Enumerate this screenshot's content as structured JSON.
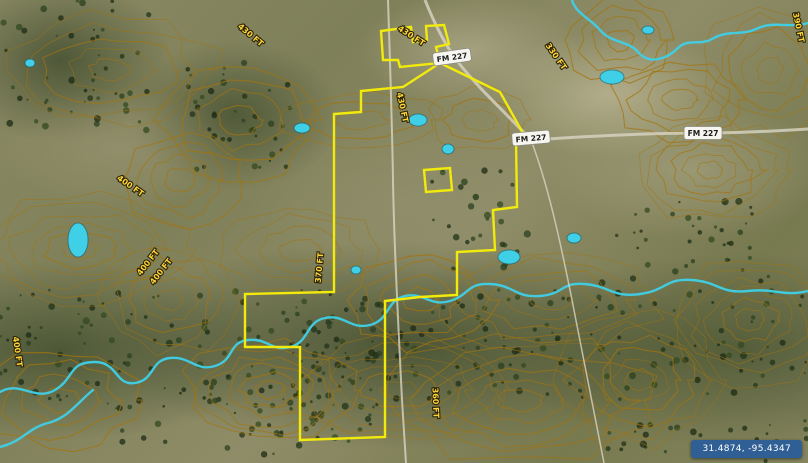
{
  "map": {
    "coordinates_badge": "31.4874, -95.4347",
    "colors": {
      "boundary": "#f2ea0b",
      "water": "#3fd0e8",
      "contour": "#a3740f",
      "label_text": "#ffd43a",
      "badge_bg": "#2f5f94",
      "road": "#d8d4c4"
    },
    "road_labels": [
      {
        "text": "FM 227",
        "x": 452,
        "y": 57,
        "rot": -8
      },
      {
        "text": "FM 227",
        "x": 531,
        "y": 138,
        "rot": -5
      },
      {
        "text": "FM 227",
        "x": 703,
        "y": 133,
        "rot": 0
      }
    ],
    "elevation_labels": [
      {
        "text": "430 FT",
        "x": 249,
        "y": 37,
        "rot": 40
      },
      {
        "text": "430 FT",
        "x": 410,
        "y": 38,
        "rot": 33
      },
      {
        "text": "430 FT",
        "x": 400,
        "y": 108,
        "rot": 78
      },
      {
        "text": "400 FT",
        "x": 129,
        "y": 188,
        "rot": 35
      },
      {
        "text": "400 FT",
        "x": 150,
        "y": 264,
        "rot": -52
      },
      {
        "text": "400 FT",
        "x": 163,
        "y": 273,
        "rot": -52
      },
      {
        "text": "370 FT",
        "x": 322,
        "y": 268,
        "rot": -85
      },
      {
        "text": "360 FT",
        "x": 433,
        "y": 403,
        "rot": 88
      },
      {
        "text": "400 FT",
        "x": 15,
        "y": 352,
        "rot": 82
      },
      {
        "text": "330 FT",
        "x": 554,
        "y": 58,
        "rot": 55
      },
      {
        "text": "390 FT",
        "x": 796,
        "y": 28,
        "rot": 78
      }
    ],
    "boundary": {
      "top_parcel": [
        [
          383,
          60
        ],
        [
          381,
          31
        ],
        [
          411,
          27
        ],
        [
          413,
          42
        ],
        [
          427,
          40
        ],
        [
          426,
          26
        ],
        [
          444,
          25
        ],
        [
          449,
          44
        ],
        [
          436,
          47
        ],
        [
          440,
          63
        ],
        [
          400,
          67
        ],
        [
          398,
          60
        ]
      ],
      "main_parcel": [
        [
          440,
          63
        ],
        [
          500,
          92
        ],
        [
          524,
          135
        ],
        [
          516,
          140
        ],
        [
          517,
          207
        ],
        [
          493,
          210
        ],
        [
          495,
          250
        ],
        [
          457,
          252
        ],
        [
          457,
          295
        ],
        [
          420,
          297
        ],
        [
          385,
          301
        ],
        [
          385,
          437
        ],
        [
          300,
          440
        ],
        [
          300,
          347
        ],
        [
          245,
          347
        ],
        [
          245,
          294
        ],
        [
          334,
          292
        ],
        [
          334,
          114
        ],
        [
          361,
          112
        ],
        [
          361,
          91
        ],
        [
          403,
          87
        ]
      ],
      "outparcel": [
        [
          424,
          170
        ],
        [
          450,
          168
        ],
        [
          452,
          190
        ],
        [
          426,
          192
        ]
      ]
    },
    "water": {
      "streams": [
        "M 0,392 C 20,380 35,402 55,390 C 75,378 68,362 95,362 C 118,362 115,386 135,383 C 155,380 150,360 170,358 C 190,356 196,372 215,366 C 235,360 228,342 248,340 C 268,338 272,352 290,347 C 310,342 305,322 325,318 C 345,314 350,330 370,325 C 390,320 386,300 405,296 C 424,292 430,307 450,301 C 470,295 466,283 490,284 C 514,285 515,298 540,296 C 565,294 560,282 585,284 C 610,286 612,298 640,294 C 668,290 665,278 692,280 C 719,282 720,294 748,291 C 776,288 782,297 808,291",
        "M 0,447 C 22,442 28,428 48,423 C 68,418 78,402 93,390",
        "M 572,0 C 576,14 590,18 600,30 C 612,44 628,40 638,52 C 650,66 668,58 678,48 C 688,38 700,46 712,39 C 730,29 742,36 756,29 C 774,20 790,29 808,23"
      ],
      "ponds": [
        {
          "cx": 302,
          "cy": 128,
          "rx": 8,
          "ry": 5
        },
        {
          "cx": 418,
          "cy": 120,
          "rx": 9,
          "ry": 6
        },
        {
          "cx": 448,
          "cy": 149,
          "rx": 6,
          "ry": 5
        },
        {
          "cx": 509,
          "cy": 257,
          "rx": 11,
          "ry": 7
        },
        {
          "cx": 78,
          "cy": 240,
          "rx": 10,
          "ry": 17
        },
        {
          "cx": 612,
          "cy": 77,
          "rx": 12,
          "ry": 7
        },
        {
          "cx": 574,
          "cy": 238,
          "rx": 7,
          "ry": 5
        },
        {
          "cx": 356,
          "cy": 270,
          "rx": 5,
          "ry": 4
        },
        {
          "cx": 30,
          "cy": 63,
          "rx": 5,
          "ry": 4
        },
        {
          "cx": 648,
          "cy": 30,
          "rx": 6,
          "ry": 4
        }
      ]
    },
    "roads": [
      {
        "d": "M 425,0 C 435,25 445,45 458,62 C 478,88 505,112 531,140",
        "w": 3
      },
      {
        "d": "M 531,140 C 590,136 650,133 703,133 C 740,133 775,131 808,129",
        "w": 3
      },
      {
        "d": "M 388,0 C 390,60 392,120 393,180 C 394,240 398,320 402,400 C 404,430 405,450 406,463",
        "w": 2
      },
      {
        "d": "M 531,140 C 548,185 560,240 572,300 C 584,360 596,420 604,463",
        "w": 1.5
      }
    ]
  }
}
